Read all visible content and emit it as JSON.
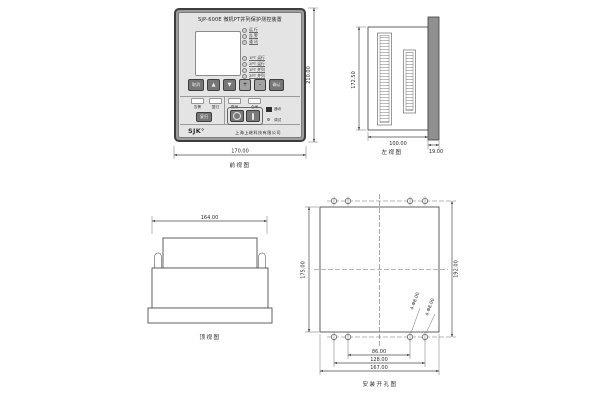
{
  "colors": {
    "background": "#ffffff",
    "line": "#4a4a4a",
    "panel_frame": "#9c9c9c",
    "panel_face": "#e4e4e4",
    "button_dark": "#767676",
    "button_light": "#a2a2a2",
    "side_panel_bar": "#909090"
  },
  "front_view": {
    "caption": "前视图",
    "dim_width": "170.00",
    "dim_height": "210.00",
    "panel": {
      "title": "SJP-600E  微机PT并列保护测控装置",
      "leds_status": [
        "运 行",
        "告 警",
        "通 讯"
      ],
      "leds_pt": [
        "1PT 运行",
        "2PT 运行",
        "1PT 并列",
        "2PT 并列"
      ],
      "keys": [
        "取消",
        "▲",
        "▼",
        "+",
        "-",
        "确认"
      ],
      "signal_labels": [
        "告警",
        "复归"
      ],
      "reset_key": "复归",
      "switch_labels": [
        "跳闸",
        "合闸"
      ],
      "open_key": "○",
      "close_key": "I",
      "port_label": "通讯",
      "debug_label": "调试",
      "logo": "SJK°",
      "company": "上海上继科技有限公司"
    }
  },
  "side_view": {
    "caption": "左视图",
    "dim_height": "172.50",
    "dim_width": "100.00",
    "dim_panel_thickness": "19.00"
  },
  "top_view": {
    "caption": "顶视图",
    "dim_width": "164.00"
  },
  "mounting_view": {
    "caption": "安装开孔图",
    "dim_cutout_height": "175.00",
    "dim_hole_span_height": "192.00",
    "dim_hole_span_1": "86.00",
    "dim_hole_span_2": "128.00",
    "dim_cutout_width": "167.00",
    "hole_spec_1": "4-Φ8.00",
    "hole_spec_2": "4-Φ8.00"
  }
}
